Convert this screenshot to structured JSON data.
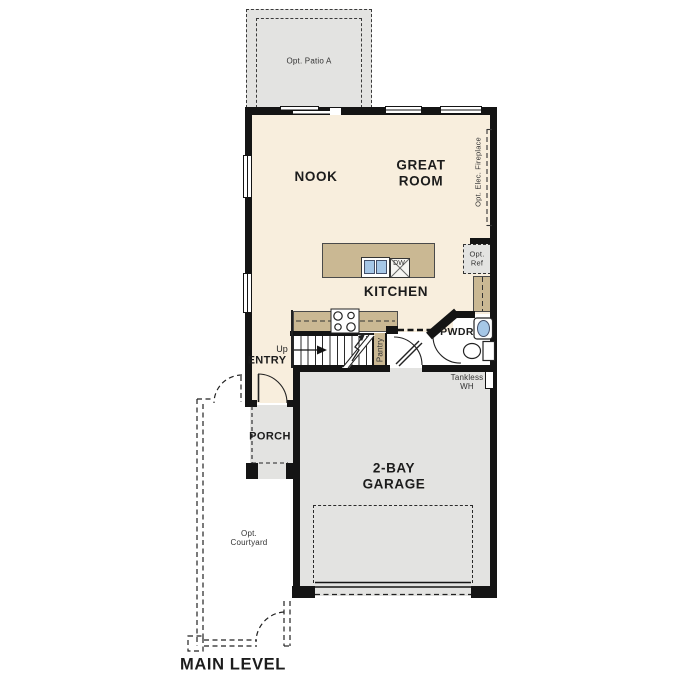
{
  "labels": {
    "opt_patio": "Opt. Patio A",
    "nook": "NOOK",
    "great_room": "GREAT ROOM",
    "opt_fireplace": "Opt. Elec. Fireplace",
    "kitchen": "KITCHEN",
    "dw": "DW",
    "opt_ref": "Opt. Ref",
    "pwdr": "PWDR",
    "entry": "ENTRY",
    "up": "Up",
    "pantry": "Pantry",
    "porch": "PORCH",
    "tankless_wh": "Tankless WH",
    "garage": "2-BAY GARAGE",
    "opt_courtyard": "Opt. Courtyard",
    "title": "MAIN LEVEL"
  },
  "colors": {
    "floor": "#f8eedd",
    "hardscape": "#e3e3e1",
    "cabinet": "#cab893",
    "sink_fixture": "#a6c7e7",
    "wall": "#141414",
    "linework": "#222222",
    "text": "#1c1c1c"
  }
}
